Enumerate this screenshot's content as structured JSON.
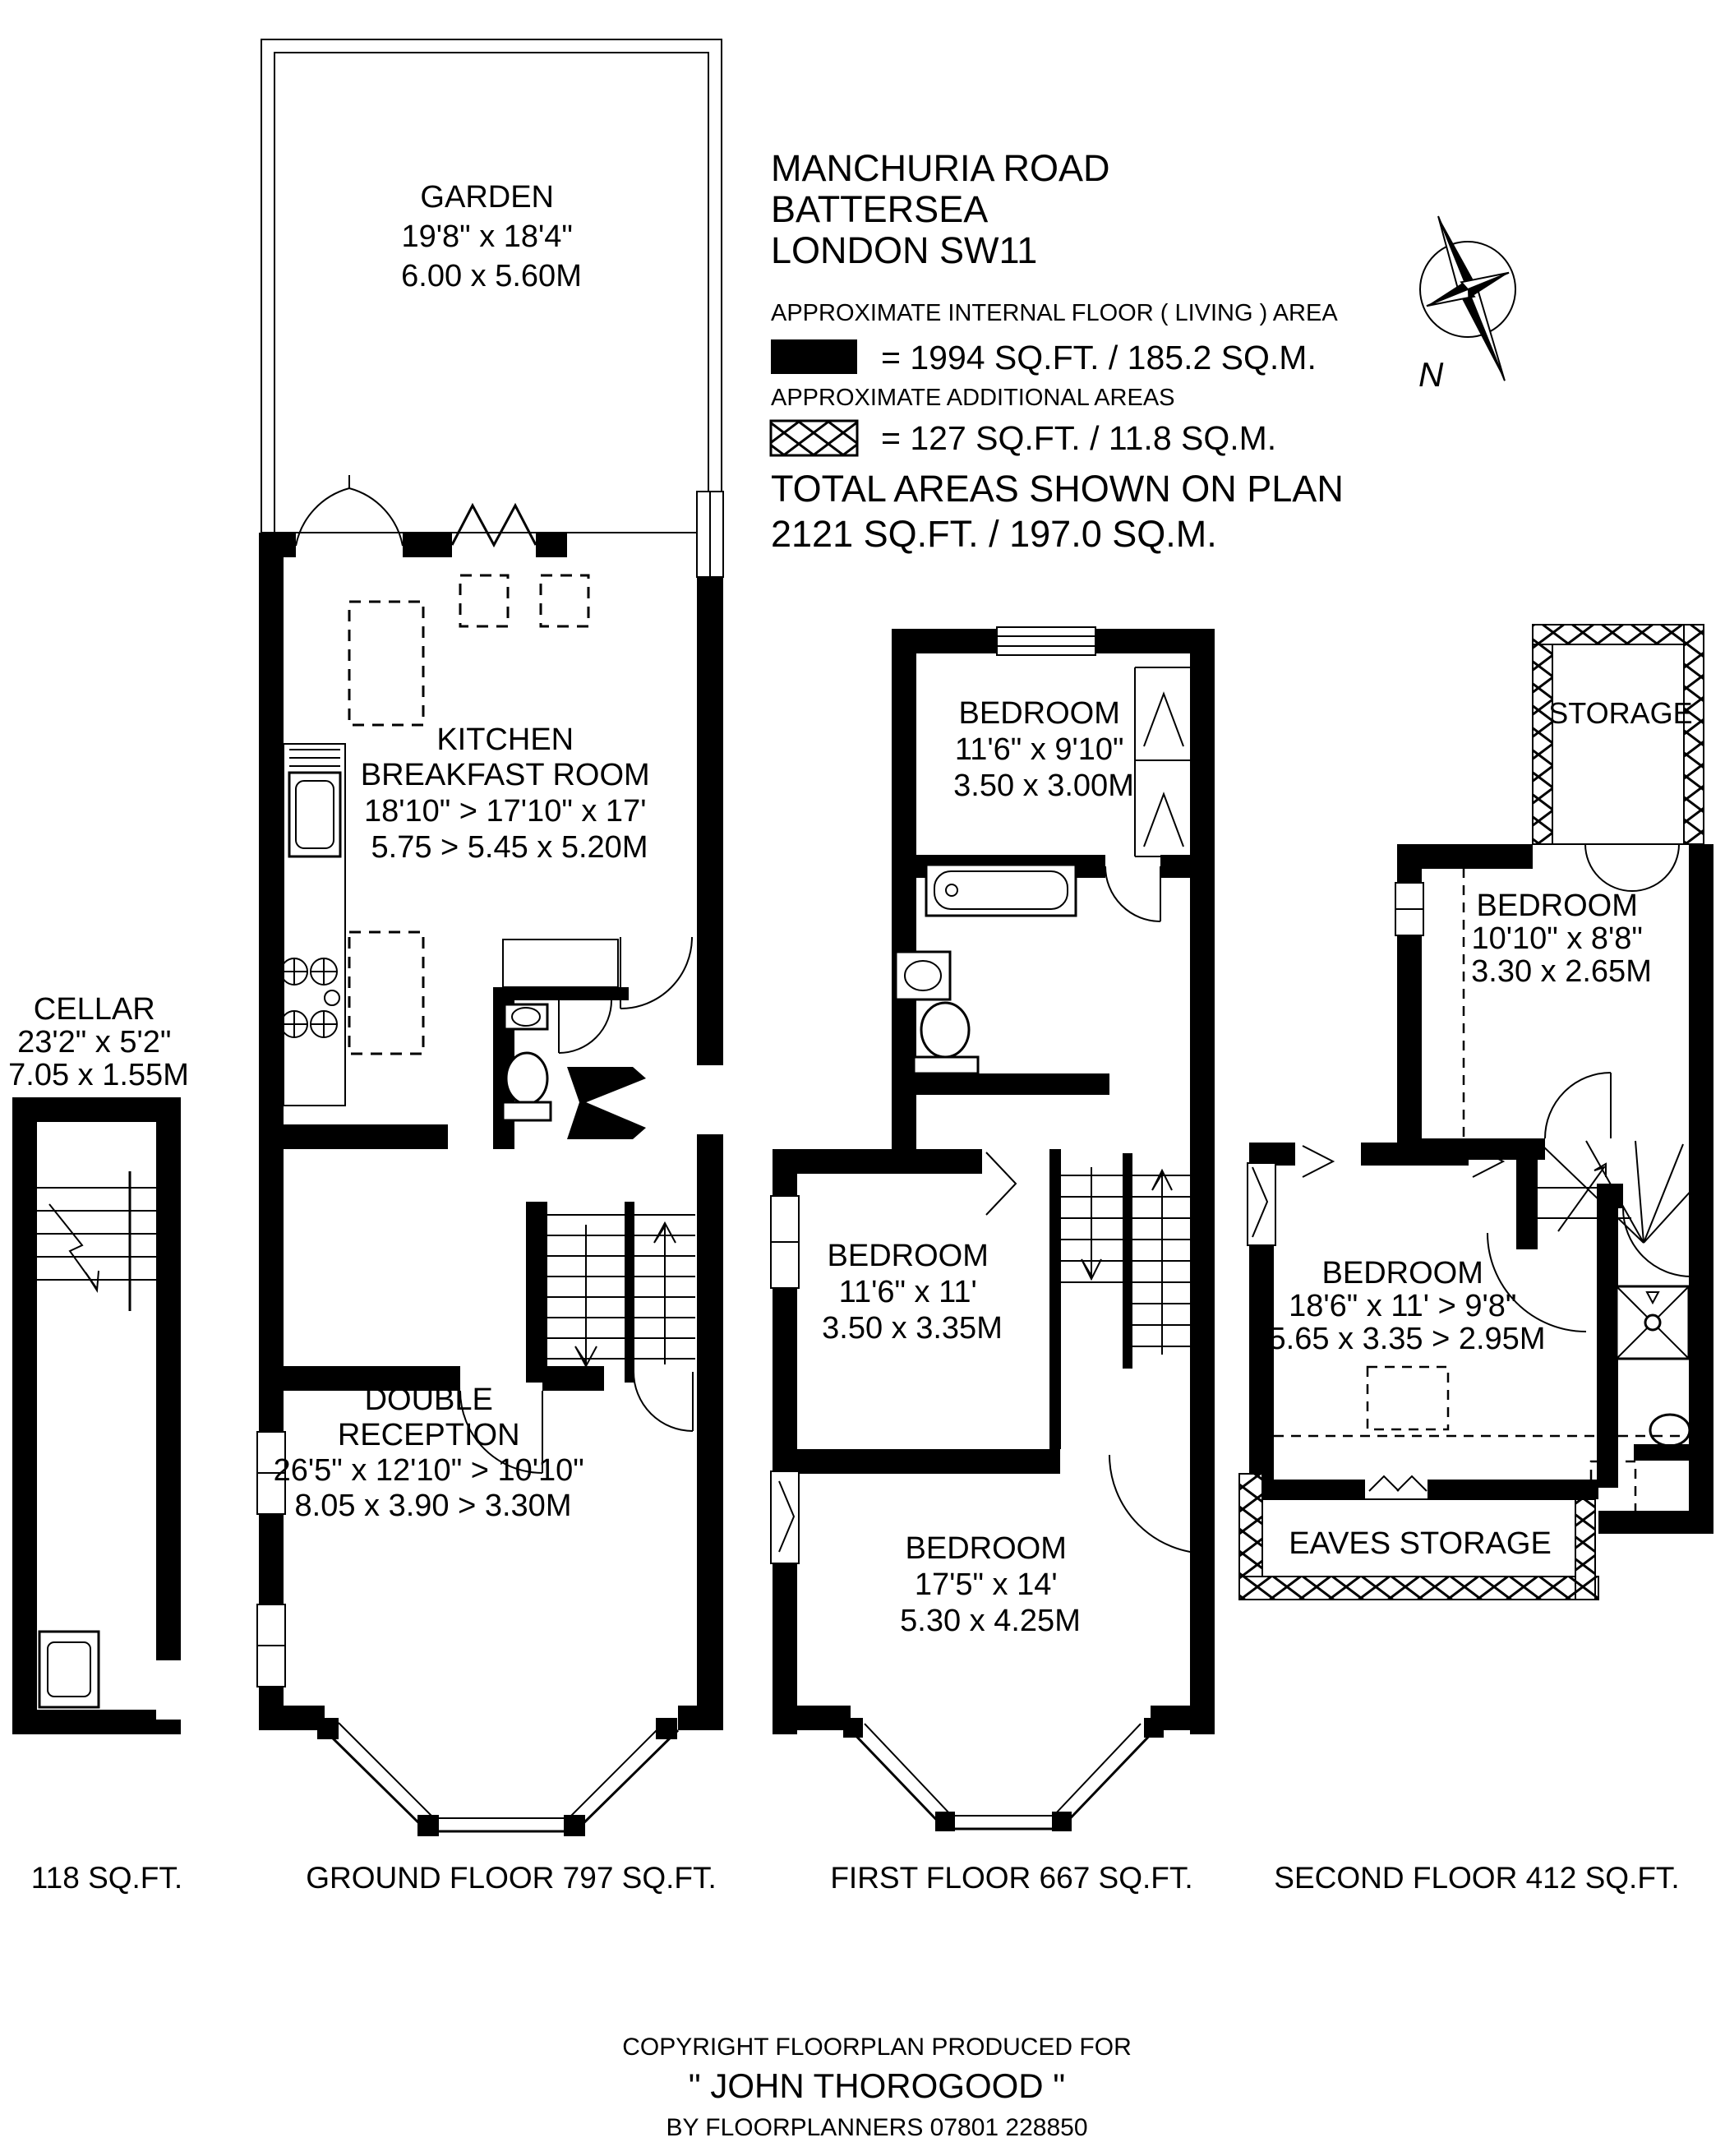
{
  "header": {
    "address_line1": "MANCHURIA ROAD",
    "address_line2": "BATTERSEA",
    "address_line3": "LONDON SW11",
    "internal_area_label": "APPROXIMATE INTERNAL FLOOR ( LIVING ) AREA",
    "internal_area_value": "= 1994 SQ.FT. / 185.2 SQ.M.",
    "additional_area_label": "APPROXIMATE ADDITIONAL AREAS",
    "additional_area_value": "= 127 SQ.FT. / 11.8 SQ.M.",
    "total_label": "TOTAL AREAS SHOWN ON PLAN",
    "total_value": "2121 SQ.FT. / 197.0 SQ.M.",
    "compass_label": "N"
  },
  "rooms": {
    "garden": {
      "name": "GARDEN",
      "dim_imperial": "19'8\" x 18'4\"",
      "dim_metric": "6.00 x 5.60M"
    },
    "kitchen": {
      "name_line1": "KITCHEN",
      "name_line2": "BREAKFAST ROOM",
      "dim_imperial": "18'10\" > 17'10\" x 17'",
      "dim_metric": "5.75 > 5.45 x 5.20M"
    },
    "cellar": {
      "name": "CELLAR",
      "dim_imperial": "23'2\" x 5'2\"",
      "dim_metric": "7.05 x 1.55M"
    },
    "double_reception": {
      "name_line1": "DOUBLE",
      "name_line2": "RECEPTION",
      "dim_imperial": "26'5\" x 12'10\" > 10'10\"",
      "dim_metric": "8.05 x 3.90 > 3.30M"
    },
    "bedroom_ff_top": {
      "name": "BEDROOM",
      "dim_imperial": "11'6\" x 9'10\"",
      "dim_metric": "3.50 x 3.00M"
    },
    "bedroom_ff_mid": {
      "name": "BEDROOM",
      "dim_imperial": "11'6\" x 11'",
      "dim_metric": "3.50 x 3.35M"
    },
    "bedroom_ff_bottom": {
      "name": "BEDROOM",
      "dim_imperial": "17'5\" x 14'",
      "dim_metric": "5.30 x 4.25M"
    },
    "storage": {
      "name": "STORAGE"
    },
    "bedroom_sf_top": {
      "name": "BEDROOM",
      "dim_imperial": "10'10\" x 8'8\"",
      "dim_metric": "3.30 x 2.65M"
    },
    "bedroom_sf_main": {
      "name": "BEDROOM",
      "dim_imperial": "18'6\" x 11' > 9'8\"",
      "dim_metric": "5.65 x 3.35 > 2.95M"
    },
    "eaves_storage": {
      "name": "EAVES STORAGE"
    }
  },
  "captions": {
    "cellar": "118 SQ.FT.",
    "ground": "GROUND FLOOR 797 SQ.FT.",
    "first": "FIRST FLOOR 667 SQ.FT.",
    "second": "SECOND FLOOR 412 SQ.FT."
  },
  "footer": {
    "line1": "COPYRIGHT FLOORPLAN PRODUCED FOR",
    "line2": "\" JOHN THOROGOOD \"",
    "line3": "BY FLOORPLANNERS 07801 228850"
  },
  "colors": {
    "wall": "#000000",
    "background": "#ffffff"
  }
}
